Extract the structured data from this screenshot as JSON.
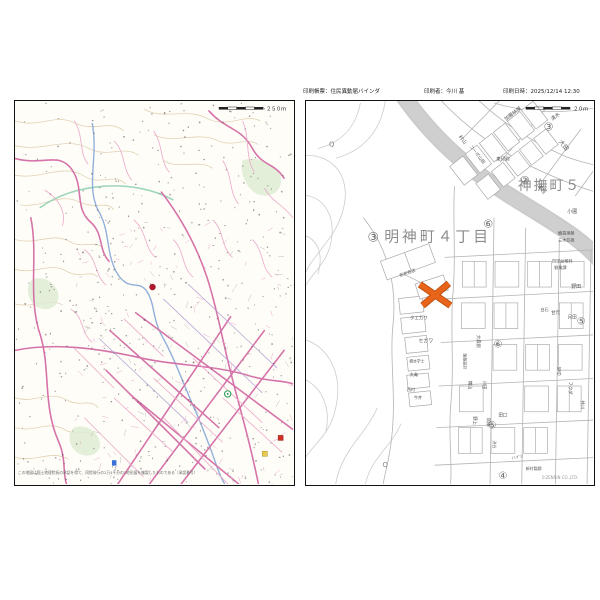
{
  "header": {
    "left": "印刷帳票：住民異動届バインダ",
    "center": "印刷者：今川 基",
    "right": "印刷日時：2025/12/14 12:30"
  },
  "left_map": {
    "scale_label": "２５０ｍ",
    "footer": "この地図は国土地理院長の承認を得て、同院発行の2万5千分の1地形図を複製したものである（承認番号）",
    "marker_color": "#b5182e",
    "accent_road_color": "#d573a8",
    "river_color": "#84a6d6"
  },
  "right_map": {
    "scale_label": "２０ｍ",
    "copyright": "©ZENRIN CO.,LTD.",
    "marker_color": "#e8641a",
    "big_labels": [
      {
        "t": "明神町４丁目",
        "x": 133,
        "y": 142,
        "s": 15,
        "ls": 3
      },
      {
        "t": "神撫町５",
        "x": 246,
        "y": 90,
        "s": 14,
        "ls": 2
      }
    ],
    "circled": [
      {
        "t": "③",
        "x": 68,
        "y": 142,
        "s": 13
      },
      {
        "t": "③",
        "x": 245,
        "y": 30,
        "s": 11
      },
      {
        "t": "②",
        "x": 221,
        "y": 84,
        "s": 11
      },
      {
        "t": "⑥",
        "x": 184,
        "y": 128,
        "s": 11
      },
      {
        "t": "⑥",
        "x": 194,
        "y": 249,
        "s": 10
      },
      {
        "t": "⑤",
        "x": 278,
        "y": 226,
        "s": 10
      },
      {
        "t": "⑤",
        "x": 188,
        "y": 331,
        "s": 10
      },
      {
        "t": "④",
        "x": 199,
        "y": 382,
        "s": 10
      }
    ],
    "labels": [
      {
        "t": "加藤納屋",
        "x": 210,
        "y": 14,
        "r": -38,
        "s": 5
      },
      {
        "t": "村山",
        "x": 157,
        "y": 40,
        "r": 52,
        "s": 5
      },
      {
        "t": "コーポ山田",
        "x": 172,
        "y": 55,
        "r": 52,
        "s": 4.5
      },
      {
        "t": "東印刷",
        "x": 199,
        "y": 60,
        "r": 0,
        "s": 4.5
      },
      {
        "t": "清水",
        "x": 253,
        "y": 17,
        "r": -38,
        "s": 5
      },
      {
        "t": "大田",
        "x": 259,
        "y": 46,
        "r": 52,
        "s": 6
      },
      {
        "t": "濱西",
        "x": 237,
        "y": 90,
        "r": 52,
        "s": 5
      },
      {
        "t": "小圃",
        "x": 269,
        "y": 113,
        "r": 0,
        "s": 5
      },
      {
        "t": "輪島理髪",
        "x": 263,
        "y": 135,
        "r": 0,
        "s": 4.2
      },
      {
        "t": "三木亞雄",
        "x": 263,
        "y": 142,
        "r": 0,
        "s": 4.2
      },
      {
        "t": "四球幼稚科",
        "x": 259,
        "y": 163,
        "r": 0,
        "s": 4.2
      },
      {
        "t": "劉業課",
        "x": 257,
        "y": 170,
        "r": 0,
        "s": 4.2
      },
      {
        "t": "野田",
        "x": 273,
        "y": 189,
        "r": 0,
        "s": 5
      },
      {
        "t": "甘元",
        "x": 252,
        "y": 215,
        "r": 0,
        "s": 4.5
      },
      {
        "t": "月田",
        "x": 269,
        "y": 220,
        "r": 0,
        "s": 4.5
      },
      {
        "t": "新京商店",
        "x": 103,
        "y": 175,
        "r": -20,
        "s": 4.2
      },
      {
        "t": "タエカワ",
        "x": 114,
        "y": 221,
        "r": 0,
        "s": 4.5
      },
      {
        "t": "セガワ",
        "x": 121,
        "y": 244,
        "r": 0,
        "s": 5
      },
      {
        "t": "橋本学士",
        "x": 112,
        "y": 264,
        "r": 0,
        "s": 3.8
      },
      {
        "t": "丸亀",
        "x": 109,
        "y": 278,
        "r": 0,
        "s": 4.2
      },
      {
        "t": "西村",
        "x": 106,
        "y": 293,
        "r": 0,
        "s": 4.2
      },
      {
        "t": "今井",
        "x": 113,
        "y": 301,
        "r": 0,
        "s": 4.2
      },
      {
        "t": "大森創",
        "x": 173,
        "y": 243,
        "r": 90,
        "s": 4.5
      },
      {
        "t": "尾藤設計",
        "x": 159,
        "y": 263,
        "r": 90,
        "s": 4
      },
      {
        "t": "横山",
        "x": 164,
        "y": 287,
        "r": 90,
        "s": 4.5
      },
      {
        "t": "川田",
        "x": 179,
        "y": 287,
        "r": 90,
        "s": 4.5
      },
      {
        "t": "白石",
        "x": 241,
        "y": 212,
        "r": 0,
        "s": 4.2
      },
      {
        "t": "SMD",
        "x": 254,
        "y": 273,
        "r": 90,
        "s": 4
      },
      {
        "t": "フクダ",
        "x": 266,
        "y": 290,
        "r": 90,
        "s": 4.5
      },
      {
        "t": "井川",
        "x": 278,
        "y": 307,
        "r": 90,
        "s": 4.5
      },
      {
        "t": "野上",
        "x": 169,
        "y": 323,
        "r": 90,
        "s": 4.5
      },
      {
        "t": "岡本",
        "x": 183,
        "y": 325,
        "r": 90,
        "s": 4.5
      },
      {
        "t": "田口",
        "x": 199,
        "y": 319,
        "r": 0,
        "s": 4.5
      },
      {
        "t": "渋谷",
        "x": 189,
        "y": 347,
        "r": 90,
        "s": 4
      },
      {
        "t": "ハイツ",
        "x": 214,
        "y": 361,
        "r": -12,
        "s": 4
      },
      {
        "t": "新村製鋼",
        "x": 230,
        "y": 373,
        "r": 0,
        "s": 4
      }
    ],
    "q_symbols": [
      {
        "x": 26,
        "y": 46
      },
      {
        "x": 80,
        "y": 370
      }
    ]
  }
}
